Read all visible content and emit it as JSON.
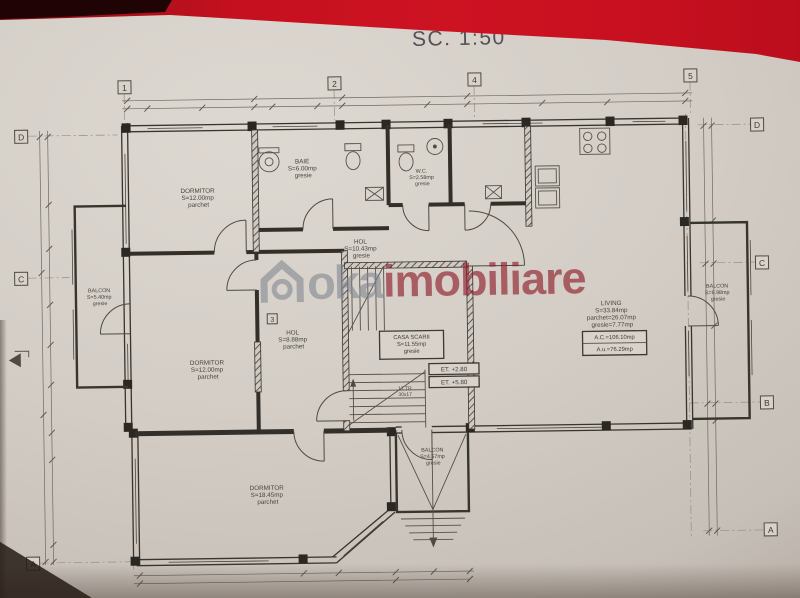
{
  "title": "SC. 1:50",
  "watermark": {
    "logo": "house-icon",
    "part1": "oka",
    "part2": "imobiliare"
  },
  "grid": {
    "top": [
      "1",
      "2",
      "4",
      "5"
    ],
    "mid": "3",
    "left": [
      "D",
      "C",
      "A"
    ],
    "right": [
      "D",
      "C",
      "B",
      "A"
    ]
  },
  "rooms": {
    "dormitor1": [
      "DORMITOR",
      "S=12.00mp",
      "parchet"
    ],
    "baie": [
      "BAIE",
      "S=6.00mp",
      "gresie"
    ],
    "wc": [
      "W.C.",
      "S=2.58mp",
      "gresie"
    ],
    "hol1": [
      "HOL",
      "S=10.43mp",
      "gresie"
    ],
    "hol2": [
      "HOL",
      "S=8.88mp",
      "parchet"
    ],
    "dormitor2": [
      "DORMITOR",
      "S=12.00mp",
      "parchet"
    ],
    "dormitor3": [
      "DORMITOR",
      "S=18.45mp",
      "parchet"
    ],
    "living": [
      "LIVING",
      "S=33.84mp",
      "parchet=26.07mp",
      "gresie=7.77mp"
    ],
    "balconLeft": [
      "BALCON",
      "S=5.40mp",
      "gresie"
    ],
    "balconRight": [
      "BALCON",
      "S=6.98mp",
      "gresie"
    ],
    "balconBottom": [
      "BALCON",
      "S=4.57mp",
      "gresie"
    ],
    "casaScarii": [
      "CASA SCARII",
      "S=11.55mp",
      "gresie"
    ]
  },
  "stairs": {
    "note": [
      "17 TR",
      "30x17"
    ]
  },
  "levels": [
    "ET. +2.80",
    "ET. +5.80"
  ],
  "area_box": [
    "A.C.=106.10mp",
    "A.u.=76.29mp"
  ],
  "colors": {
    "photo_red": "#c41120",
    "paper": "#d2ccc5",
    "ink": "#38342e",
    "watermark_gray": "#80868f",
    "watermark_red": "#8d1c29"
  }
}
